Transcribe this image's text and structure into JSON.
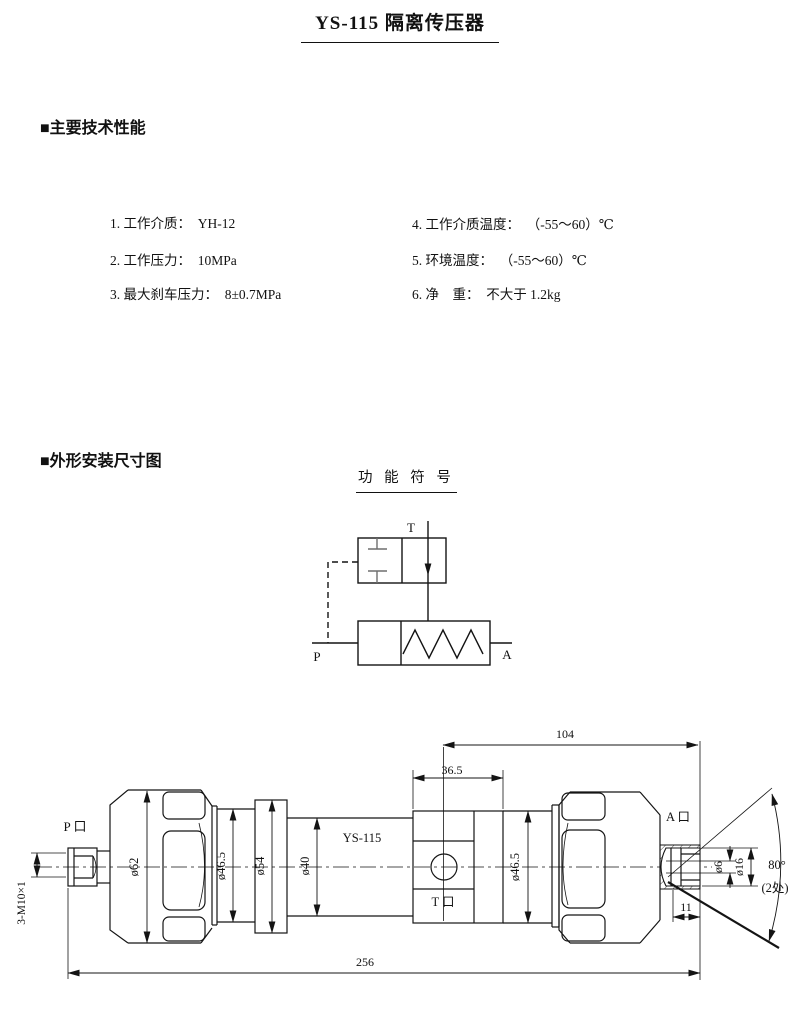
{
  "title": "YS-115 隔离传压器",
  "sections": {
    "specs": "■主要技术性能",
    "outline": "■外形安装尺寸图"
  },
  "specs_left": [
    "1. 工作介质：  YH-12",
    "2. 工作压力：  10MPa",
    "3. 最大刹车压力：  8±0.7MPa"
  ],
  "specs_right": [
    "4. 工作介质温度：  （-55～60）℃",
    "5. 环境温度：  （-55～60）℃",
    "6. 净　重：  不大于 1.2kg"
  ],
  "schematic": {
    "title": "功 能 符 号",
    "port_t": "T",
    "port_p": "P",
    "port_a": "A"
  },
  "drawing": {
    "model": "YS-115",
    "port_p": "P 口",
    "port_t": "T 口",
    "port_a": "A 口",
    "thread_spec": "3-M10×1",
    "dia_62": "ø62",
    "dia_46_5_left": "ø46.5",
    "dia_54": "ø54",
    "dia_40": "ø40",
    "dia_46_5_right": "ø46.5",
    "dia_6": "ø6",
    "dia_16": "ø16",
    "len_104": "104",
    "len_36_5": "36.5",
    "len_256": "256",
    "len_11": "11",
    "angle": "80°",
    "angle_note": "(2处)"
  }
}
